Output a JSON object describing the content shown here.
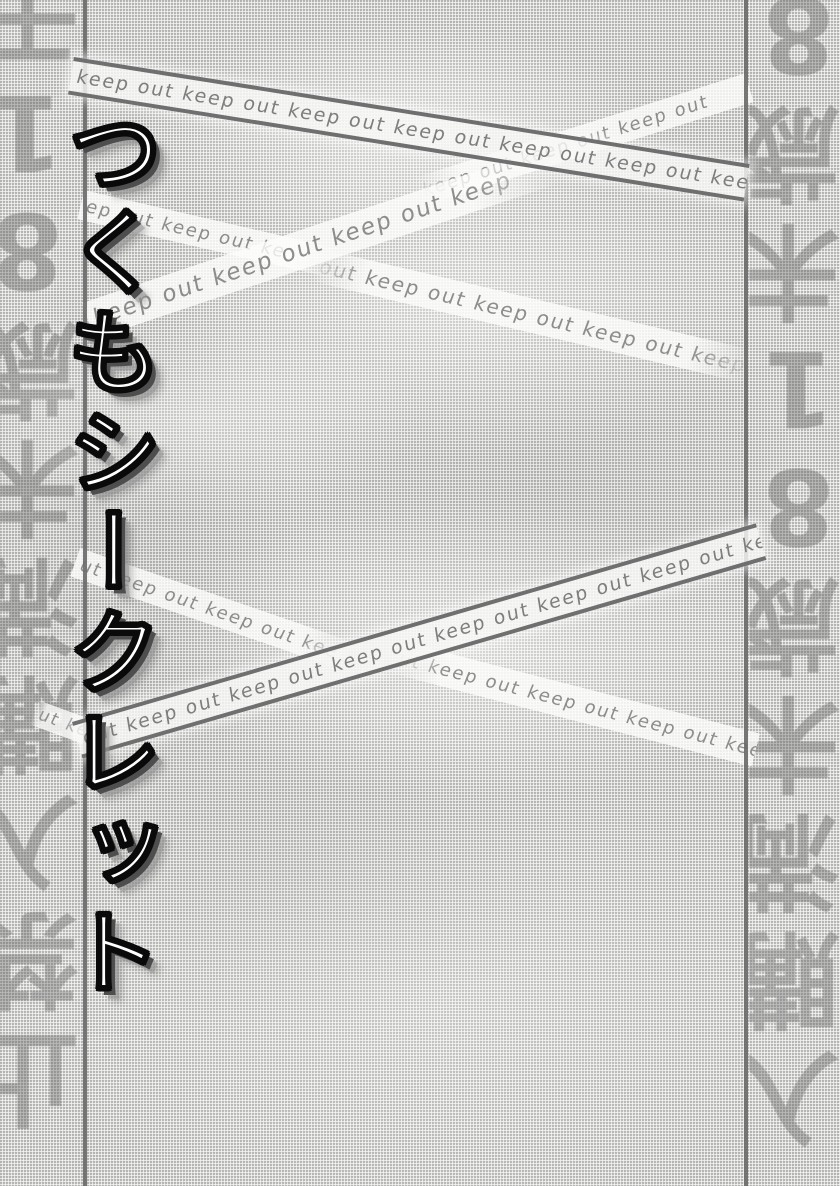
{
  "page": {
    "title": "つくもシークレット",
    "watermarks": {
      "left": "干18歳未満購入禁止",
      "right": "8歳未18歳未満購入"
    },
    "tapes": {
      "band_top": "keep out keep out keep out keep out keep out keep out keep out",
      "band_mid": "out keep out keep out keep out keep out keep out keep out keep out keep",
      "strip_top": "keep out keep out keep out",
      "p2_desc_a": "ep out keep out ke",
      "p2_desc_b": "out keep out keep out keep out keep out ke",
      "p2_asc": "keep out keep out keep out keep",
      "p2_low": "ut keep out keep out kee",
      "margin_frag": "ut ke",
      "p3_desc": "ut keep out keep out keep out keep out keep out ke"
    },
    "colors": {
      "paper_base": "#e6e6e4",
      "panel_line": "#6b6b6b",
      "tape_text": "#8d8d8d",
      "title_fill": "#ffffff",
      "title_outline": "#0a0a0a",
      "title_shadow": "#4e4e4e"
    }
  }
}
